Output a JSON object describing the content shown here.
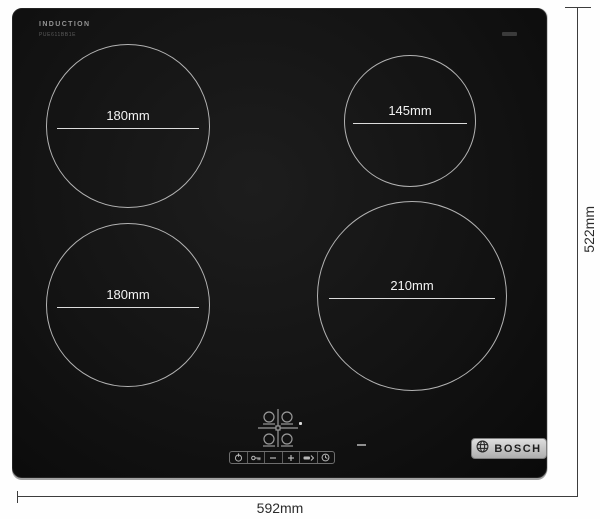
{
  "hob": {
    "type_label": "INDUCTION",
    "model_label": "PUE611BB1E",
    "surface_color": "#121212",
    "zone_outline_color": "#b3b3b3"
  },
  "zones": [
    {
      "position": "rear-left",
      "label": "180mm"
    },
    {
      "position": "rear-right",
      "label": "145mm"
    },
    {
      "position": "front-left",
      "label": "180mm"
    },
    {
      "position": "front-right",
      "label": "210mm"
    }
  ],
  "controls": {
    "icons": [
      "power-icon",
      "key-lock-icon",
      "minus-icon",
      "plus-icon",
      "boost-icon",
      "timer-icon"
    ]
  },
  "brand": {
    "logo_text": "BOSCH"
  },
  "dimensions": {
    "width_label": "592mm",
    "height_label": "522mm",
    "line_color": "#3d3d3d"
  }
}
